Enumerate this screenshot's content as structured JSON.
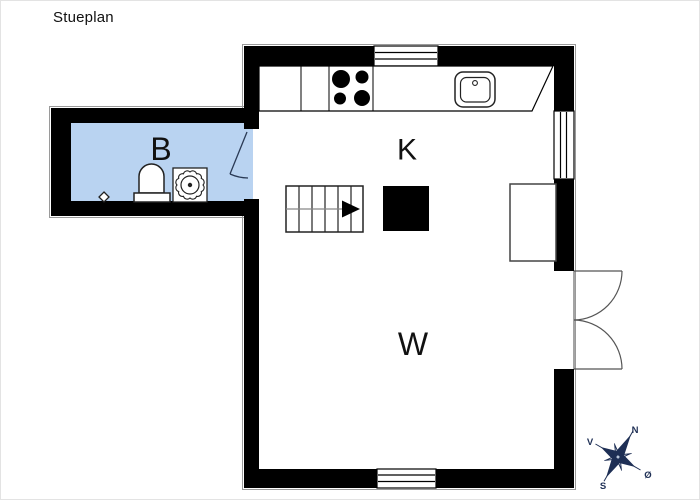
{
  "title": "Stueplan",
  "rooms": {
    "bathroom": {
      "label": "B",
      "fill": "#b9d3f1"
    },
    "kitchen": {
      "label": "K"
    },
    "living_room": {
      "label": "W"
    }
  },
  "compass": {
    "n": "N",
    "e": "Ø",
    "s": "S",
    "w": "V",
    "color": "#1e2f55"
  },
  "colors": {
    "wall": "#000000",
    "line": "#222222"
  },
  "fixtures": {
    "toilet": "toilet",
    "shower": "shower-drain",
    "floor_drain": "floor-drain",
    "stove": "stove-four-burners",
    "sink": "kitchen-sink",
    "stairs": "stairs-up-arrow",
    "chimney": "chimney-block",
    "cabinet": "built-in-cabinet",
    "double_door": "double-french-door",
    "bath_door": "bathroom-door",
    "windows": [
      "window-top",
      "window-right",
      "window-bottom"
    ]
  }
}
